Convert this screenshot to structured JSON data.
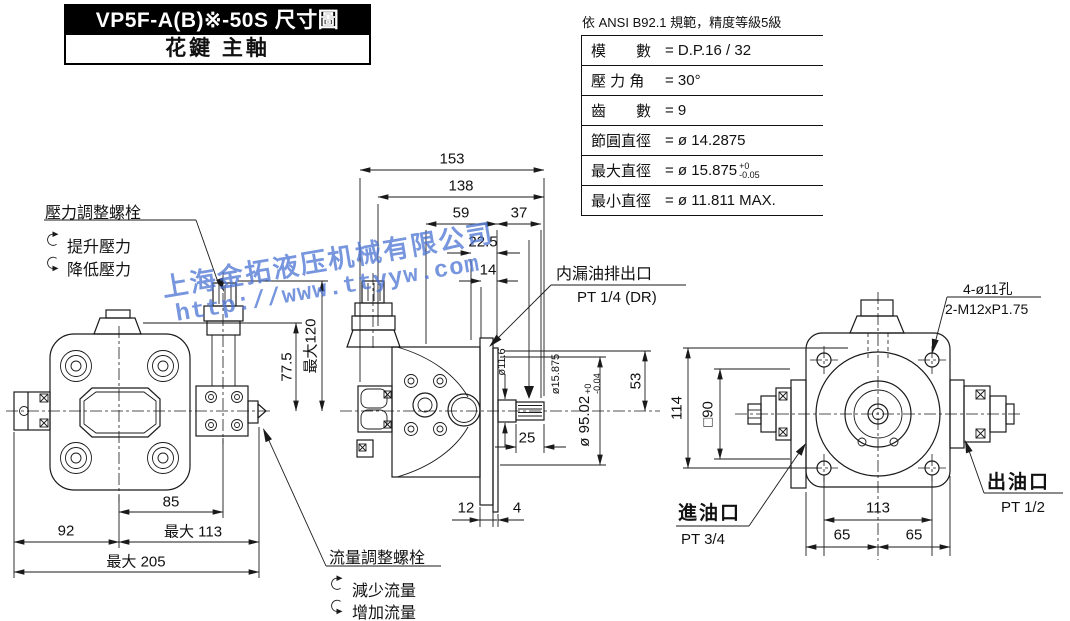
{
  "colors": {
    "line": "#1a1a1a",
    "watermark": "#4a73d4"
  },
  "title_block": {
    "model_line": "VP5F-A(B)※-50S 尺寸圖",
    "shaft_line": "花鍵 主軸"
  },
  "spline_table": {
    "note": "依 ANSI B92.1 規範，精度等級5級",
    "rows": [
      {
        "label": "模　　數",
        "value": "= D.P.16 / 32"
      },
      {
        "label": "壓 力 角",
        "value": "= 30°"
      },
      {
        "label": "齒　　數",
        "value": "= 9"
      },
      {
        "label": "節圓直徑",
        "value": "= ø 14.2875"
      },
      {
        "label": "最大直徑",
        "value": "= ø 15.875",
        "tol_top": "+0",
        "tol_bot": "-0.05"
      },
      {
        "label": "最小直徑",
        "value": "= ø 11.811 MAX."
      }
    ]
  },
  "callouts": {
    "pressure": {
      "title": "壓力調整螺栓",
      "cw": "提升壓力",
      "ccw": "降低壓力"
    },
    "flow": {
      "title": "流量調整螺栓",
      "cw": "減少流量",
      "ccw": "增加流量"
    },
    "drain": {
      "name": "内漏油排出口",
      "port": "PT 1/4 (DR)"
    },
    "mount_holes": {
      "line1": "4-ø11孔",
      "line2": "2-M12xP1.75"
    },
    "inlet": {
      "name": "進油口",
      "port": "PT 3/4"
    },
    "outlet": {
      "name": "出油口",
      "port": "PT 1/2"
    }
  },
  "dims": {
    "front_top": {
      "d153": "153",
      "d138": "138",
      "d59": "59",
      "d37": "37",
      "d22_5": "22.5",
      "d14": "14"
    },
    "front_v": {
      "d77_5": "77.5",
      "dmax120": "最大120",
      "d53": "53",
      "dia95": "ø 95.02",
      "dia95_tol_top": "+0",
      "dia95_tol_bot": "-0.04",
      "dia15875": "ø15.875",
      "dia11_6": "ø11.6"
    },
    "front_b": {
      "d25": "25",
      "d12": "12",
      "d4": "4"
    },
    "left_b": {
      "d85": "85",
      "d92": "92",
      "dmax113": "最大 113",
      "dmax205": "最大 205"
    },
    "side": {
      "d114": "114",
      "sq90": "□90",
      "d113": "113",
      "d65a": "65",
      "d65b": "65"
    }
  },
  "watermark": {
    "company": "上海金拓液压机械有限公司",
    "url": "http://www.ttyyw.com"
  }
}
